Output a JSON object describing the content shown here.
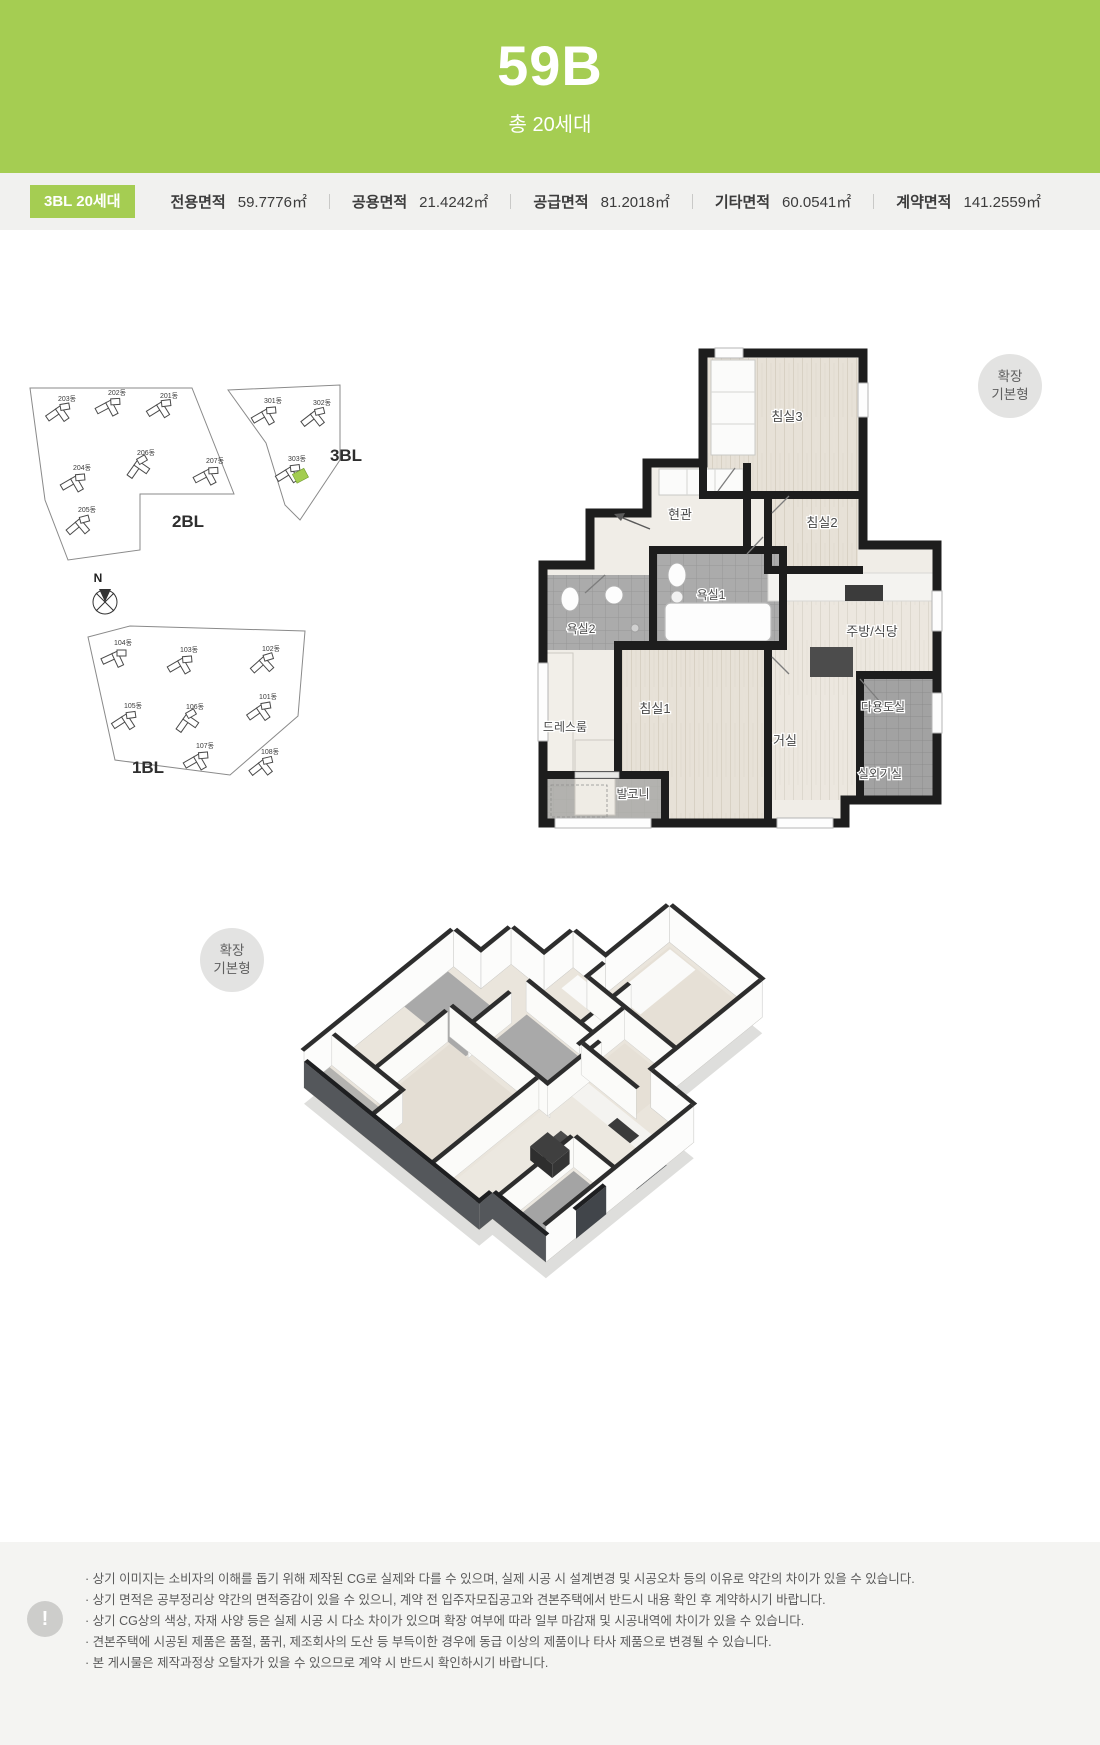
{
  "header": {
    "title": "59B",
    "subtitle": "총 20세대"
  },
  "info_bar": {
    "badge": "3BL 20세대",
    "items": [
      {
        "label": "전용면적",
        "value": "59.7776㎡"
      },
      {
        "label": "공용면적",
        "value": "21.4242㎡"
      },
      {
        "label": "공급면적",
        "value": "81.2018㎡"
      },
      {
        "label": "기타면적",
        "value": "60.0541㎡"
      },
      {
        "label": "계약면적",
        "value": "141.2559㎡"
      }
    ]
  },
  "site_plan": {
    "labels": {
      "bl2": "2BL",
      "bl3": "3BL",
      "bl1": "1BL",
      "compass": "N"
    },
    "blocks2": [
      "201동",
      "202동",
      "203동",
      "204동",
      "205동",
      "206동",
      "207동"
    ],
    "blocks3": [
      "301동",
      "302동",
      "303동"
    ],
    "blocks1": [
      "101동",
      "102동",
      "103동",
      "104동",
      "105동",
      "106동",
      "107동",
      "108동"
    ],
    "highlight_building": "303동",
    "highlight_color": "#a3cd50"
  },
  "plan_badge": {
    "line1": "확장",
    "line2": "기본형"
  },
  "plan2d": {
    "rooms": [
      "침실3",
      "침실2",
      "현관",
      "욕실1",
      "욕실2",
      "주방/식당",
      "다용도실",
      "실외기실",
      "거실",
      "침실1",
      "드레스룸",
      "발코니"
    ]
  },
  "footer": {
    "mark": "!",
    "notes": [
      "· 상기 이미지는 소비자의 이해를 돕기 위해 제작된 CG로 실제와 다를 수 있으며, 실제 시공 시 설계변경 및 시공오차 등의 이유로 약간의 차이가 있을 수 있습니다.",
      "· 상기 면적은 공부정리상 약간의 면적증감이 있을 수 있으니, 계약 전 입주자모집공고와 견본주택에서 반드시 내용 확인 후 계약하시기 바랍니다.",
      "· 상기 CG상의 색상, 자재 사양 등은 실제 시공 시 다소 차이가 있으며 확장 여부에 따라 일부 마감재 및 시공내역에 차이가 있을 수 있습니다.",
      "· 견본주택에 시공된 제품은 품절, 품귀, 제조회사의 도산 등 부득이한 경우에 동급 이상의 제품이나 타사 제품으로 변경될 수 있습니다.",
      "· 본 게시물은 제작과정상 오탈자가 있을 수 있으므로 계약 시 반드시 확인하시기 바랍니다."
    ]
  }
}
